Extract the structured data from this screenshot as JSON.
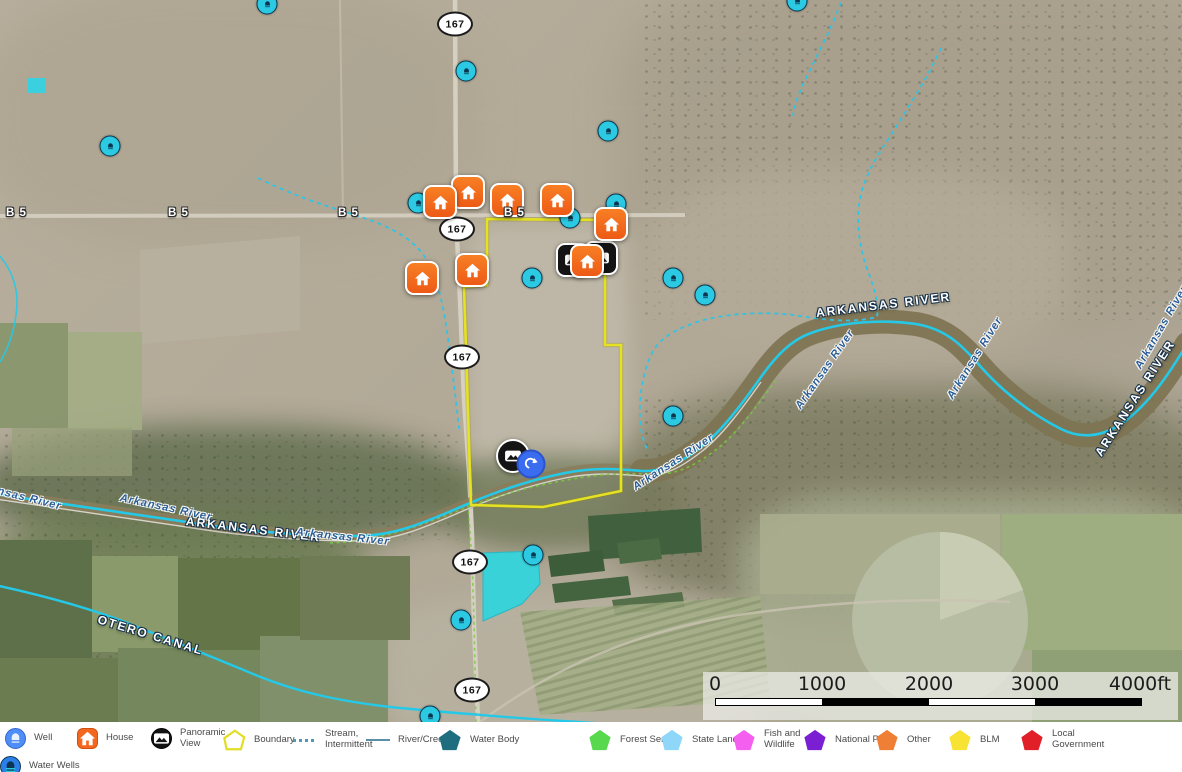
{
  "map": {
    "title": "Water Wells",
    "highway_shields": [
      {
        "label": "167",
        "x": 455,
        "y": 24
      },
      {
        "label": "167",
        "x": 457,
        "y": 229
      },
      {
        "label": "167",
        "x": 462,
        "y": 357
      },
      {
        "label": "167",
        "x": 470,
        "y": 562
      },
      {
        "label": "167",
        "x": 472,
        "y": 690
      }
    ],
    "road_labels": [
      {
        "label": "B 5",
        "x": 6,
        "y": 207
      },
      {
        "label": "B 5",
        "x": 168,
        "y": 207
      },
      {
        "label": "B 5",
        "x": 338,
        "y": 207
      },
      {
        "label": "B 5",
        "x": 504,
        "y": 207
      }
    ],
    "water_labels": [
      {
        "text": "ARKANSAS RIVER",
        "x": 186,
        "y": 514,
        "rot": 7,
        "style": "caps"
      },
      {
        "text": "ARKANSAS RIVER",
        "x": 816,
        "y": 306,
        "rot": -7,
        "style": "caps"
      },
      {
        "text": "ARKANSAS RIVER",
        "x": 1098,
        "y": 448,
        "rot": -57,
        "style": "caps"
      },
      {
        "text": "OTERO CANAL",
        "x": 98,
        "y": 612,
        "rot": 17,
        "style": "caps"
      },
      {
        "text": "Arkansas River",
        "x": -30,
        "y": 478,
        "rot": 14,
        "style": "ital"
      },
      {
        "text": "Arkansas River",
        "x": 120,
        "y": 492,
        "rot": 12,
        "style": "ital"
      },
      {
        "text": "Arkansas River",
        "x": 296,
        "y": 526,
        "rot": 6,
        "style": "ital"
      },
      {
        "text": "Arkansas River",
        "x": 634,
        "y": 482,
        "rot": -33,
        "style": "ital"
      },
      {
        "text": "Arkansas River",
        "x": 798,
        "y": 402,
        "rot": -55,
        "style": "ital"
      },
      {
        "text": "Arkansas River",
        "x": 950,
        "y": 392,
        "rot": -58,
        "style": "ital"
      },
      {
        "text": "Arkansas River",
        "x": 1138,
        "y": 362,
        "rot": -60,
        "style": "ital"
      }
    ],
    "markers": {
      "well": [
        [
          267,
          4
        ],
        [
          797,
          1
        ],
        [
          466,
          71
        ],
        [
          608,
          131
        ],
        [
          110,
          146
        ],
        [
          418,
          203
        ],
        [
          616,
          204
        ],
        [
          570,
          218
        ],
        [
          532,
          278
        ],
        [
          673,
          278
        ],
        [
          705,
          295
        ],
        [
          673,
          416
        ],
        [
          533,
          555
        ],
        [
          461,
          620
        ],
        [
          430,
          716
        ]
      ],
      "house": [
        [
          468,
          192
        ],
        [
          507,
          200
        ],
        [
          557,
          200
        ],
        [
          440,
          202
        ],
        [
          611,
          224
        ],
        [
          472,
          270
        ],
        [
          422,
          278
        ],
        [
          587,
          261
        ]
      ],
      "panorama_square": [
        [
          573,
          260
        ],
        [
          601,
          258
        ]
      ],
      "panorama_circle": [
        [
          513,
          456
        ]
      ],
      "street_view": [
        [
          531,
          464
        ]
      ]
    }
  },
  "scale_bar": {
    "labels": [
      "0",
      "1000",
      "2000",
      "3000",
      "4000ft"
    ]
  },
  "legend": {
    "row1": [
      {
        "name": "well",
        "type": "well",
        "label": "Well",
        "x": 5
      },
      {
        "name": "house",
        "type": "house",
        "label": "House",
        "x": 77
      },
      {
        "name": "panoramic-view",
        "type": "panorama",
        "label": "Panoramic View",
        "x": 151
      },
      {
        "name": "boundary",
        "type": "boundary",
        "label": "Boundary",
        "x": 222
      },
      {
        "name": "stream-intermittent",
        "type": "stream",
        "label": "Stream, Intermittent",
        "x": 293
      },
      {
        "name": "river-creek",
        "type": "river",
        "label": "River/Creek",
        "x": 366
      },
      {
        "name": "water-body",
        "type": "pentagon",
        "color": "#1e6e80",
        "label": "Water Body",
        "x": 438
      },
      {
        "name": "forest-service",
        "type": "pentagon",
        "color": "#58d94d",
        "label": "Forest Servic",
        "x": 588
      },
      {
        "name": "state-land",
        "type": "pentagon",
        "color": "#8ed7f8",
        "label": "State Land",
        "x": 660
      },
      {
        "name": "fish-and-wildlife",
        "type": "pentagon",
        "color": "#f55ff0",
        "label": "Fish and Wildlife",
        "x": 732
      },
      {
        "name": "national-park",
        "type": "pentagon",
        "color": "#7b1fd3",
        "label": "National Park",
        "x": 803
      },
      {
        "name": "other",
        "type": "pentagon",
        "color": "#ef7f35",
        "label": "Other",
        "x": 875
      },
      {
        "name": "blm",
        "type": "pentagon",
        "color": "#f8e234",
        "label": "BLM",
        "x": 948
      },
      {
        "name": "local-government",
        "type": "pentagon",
        "color": "#e01f29",
        "label": "Local Government",
        "x": 1020
      }
    ],
    "row2": [
      {
        "name": "water-wells",
        "type": "waterwells",
        "label": "Water Wells",
        "x": 0
      }
    ]
  },
  "colors": {
    "well_marker": "#2bc9e2",
    "house_marker": "#f4671f",
    "panorama_marker": "#141414",
    "street_view_marker": "#3a6cf0",
    "boundary": "#e6e222",
    "river_line": "#25c9e8",
    "legend_well": "#4f8df7",
    "legend_water_wells": "#2a7fe8",
    "water_body": "#1e6e80",
    "forest_service": "#58d94d",
    "state_land": "#8ed7f8",
    "fish_and_wildlife": "#f55ff0",
    "national_park": "#7b1fd3",
    "other": "#ef7f35",
    "blm": "#f8e234",
    "local_government": "#e01f29"
  }
}
